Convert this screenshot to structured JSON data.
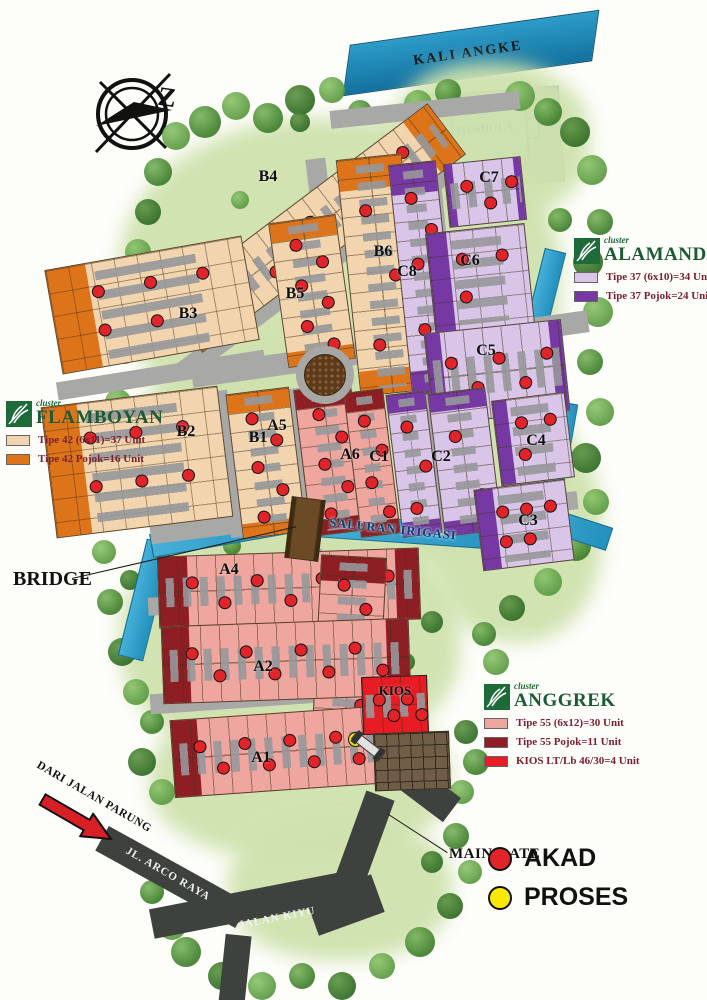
{
  "labels": {
    "river": "KALI ANGKE",
    "irrigation": "SALURAN IRIGASI",
    "bridge": "BRIDGE",
    "main_gate": "MAIN GATE",
    "mushola": "MUSHOLA",
    "from_road": "DARI JALAN PARUNG",
    "arco_road": "JL. ARCO RAYA",
    "kiyu_road": "JALAN KIYU",
    "compass_north": "Z"
  },
  "legends": {
    "flamboyan": {
      "cluster": "cluster",
      "name": "FLAMBOYAN",
      "items": [
        {
          "swatch": "#f2d5ae",
          "text": "Tipe 42 (6x11)=37 Unit"
        },
        {
          "swatch": "#de7419",
          "text": "Tipe 42 Pojok=16 Unit"
        }
      ]
    },
    "alamanda": {
      "cluster": "cluster",
      "name": "ALAMANDA",
      "items": [
        {
          "swatch": "#d8c5e7",
          "text": "Tipe 37 (6x10)=34 Unit"
        },
        {
          "swatch": "#7638a2",
          "text": "Tipe 37 Pojok=24 Unit"
        }
      ]
    },
    "anggrek": {
      "cluster": "cluster",
      "name": "ANGGREK",
      "items": [
        {
          "swatch": "#eea69f",
          "text": "Tipe 55 (6x12)=30 Unit"
        },
        {
          "swatch": "#8c1e24",
          "text": "Tipe 55 Pojok=11 Unit"
        },
        {
          "swatch": "#e71c24",
          "text": "KIOS LT/Lb 46/30=4 Unit"
        }
      ]
    }
  },
  "status_legend": [
    {
      "label": "AKAD",
      "color": "#e1242a"
    },
    {
      "label": "PROSES",
      "color": "#fae800"
    }
  ],
  "blocks": [
    {
      "id": "B4",
      "label": "B4",
      "akad_dots": 5
    },
    {
      "id": "B3",
      "label": "B3",
      "akad_dots": 5
    },
    {
      "id": "B2",
      "label": "B2",
      "akad_dots": 6
    },
    {
      "id": "B1",
      "label": "B1",
      "akad_dots": 5
    },
    {
      "id": "B5",
      "label": "B5",
      "akad_dots": 6
    },
    {
      "id": "B6",
      "label": "B6",
      "akad_dots": 3
    },
    {
      "id": "C8",
      "label": "C8",
      "akad_dots": 6
    },
    {
      "id": "C7",
      "label": "C7",
      "akad_dots": 3
    },
    {
      "id": "C6",
      "label": "C6",
      "akad_dots": 3
    },
    {
      "id": "C5",
      "label": "C5",
      "akad_dots": 5
    },
    {
      "id": "A5",
      "label": "A5",
      "akad_dots": 5
    },
    {
      "id": "A6",
      "label": "A6",
      "akad_dots": 4
    },
    {
      "id": "C1",
      "label": "C1",
      "akad_dots": 3
    },
    {
      "id": "C2",
      "label": "C2",
      "akad_dots": 2
    },
    {
      "id": "C4",
      "label": "C4",
      "akad_dots": 3
    },
    {
      "id": "C3",
      "label": "C3",
      "akad_dots": 5
    },
    {
      "id": "A4",
      "label": "A4",
      "akad_dots": 7
    },
    {
      "id": "A3",
      "label": "A3",
      "akad_dots": 7
    },
    {
      "id": "A2",
      "label": "A2",
      "akad_dots": 8
    },
    {
      "id": "A1",
      "label": "A1",
      "akad_dots": 9
    },
    {
      "id": "KIOS",
      "label": "KIOS",
      "akad_dots": 4
    }
  ],
  "proses_points": [
    {
      "at": "bridge"
    },
    {
      "at": "main gate"
    }
  ],
  "colors": {
    "akad": "#e1242a",
    "proses": "#fae800",
    "road": "#a8a8a6",
    "water": "#2d9cc9"
  }
}
